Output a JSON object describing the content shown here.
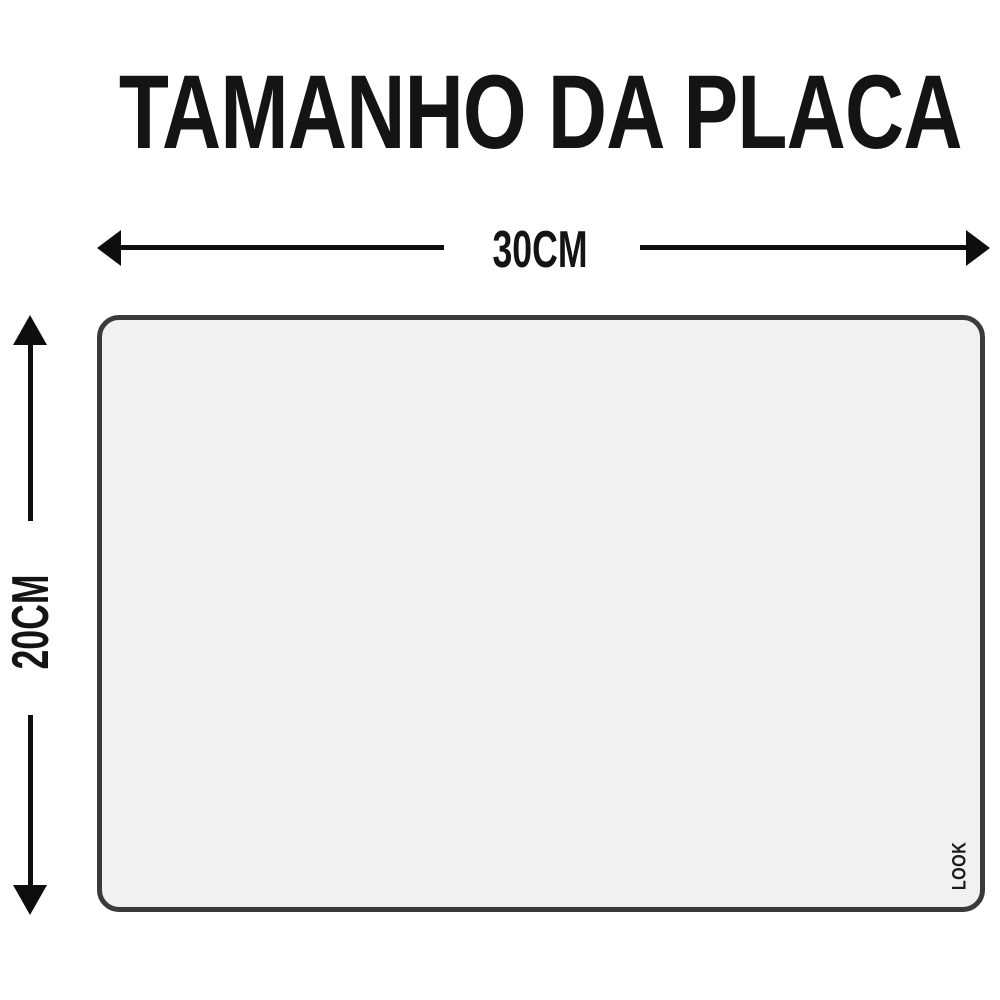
{
  "title": "TAMANHO DA PLACA",
  "dimensions": {
    "width": {
      "label": "30CM"
    },
    "height": {
      "label": "20CM"
    }
  },
  "plate": {
    "brand": "LOOK",
    "fill_color": "#f1f1f1",
    "border_color": "#3a3a3a"
  },
  "colors": {
    "background": "#ffffff",
    "text": "#141414",
    "arrow": "#0e0e0e"
  }
}
